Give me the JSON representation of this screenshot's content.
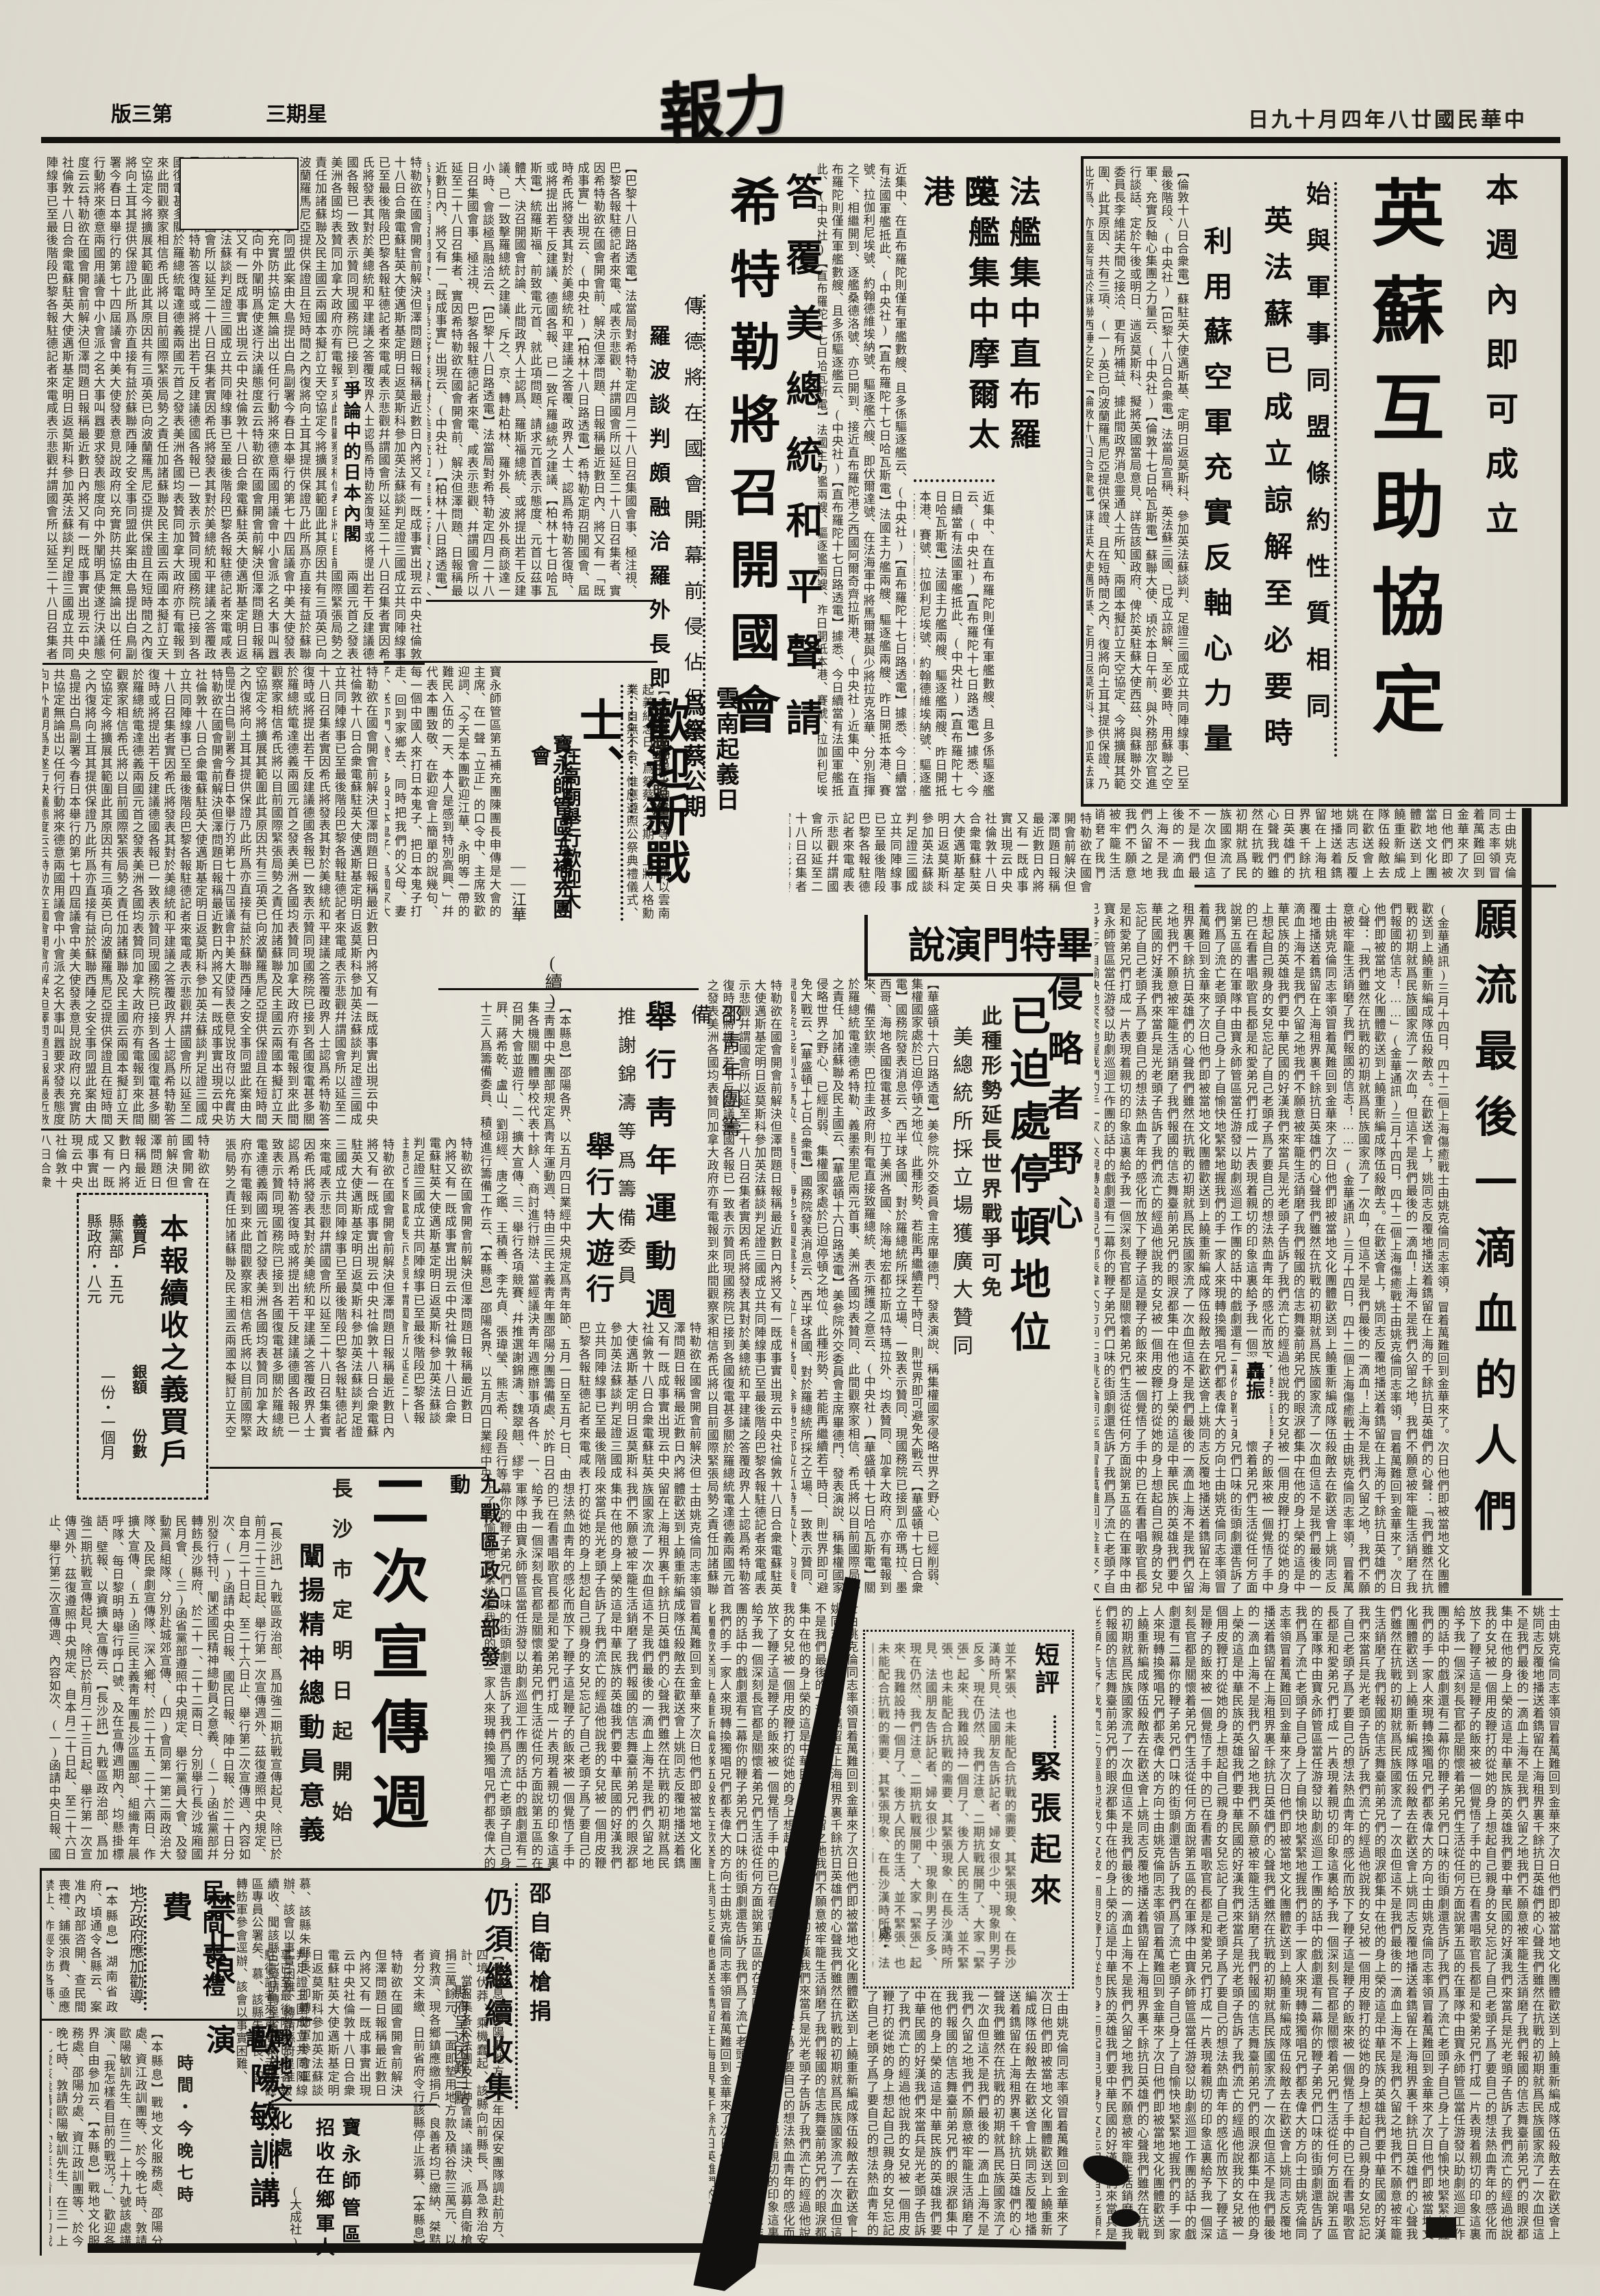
{
  "colors": {
    "ink": "#141310",
    "paper": "#e5e1d5"
  },
  "header": {
    "edition": "第三版",
    "weekday": "星期三",
    "masthead": "力報",
    "date": "中華民國廿八年四月十九日"
  },
  "a_yingsu": {
    "kicker": "本週內即可成立",
    "headline": "英蘇互助協定",
    "deck1": "始與軍事同盟條約性質相同",
    "deck2": "英法蘇已成立諒解至必要時",
    "deck3": "利用蘇空軍充實反軸心力量",
    "body": "【倫敦十八日合衆電】蘇駐英大使邁斯基、定明日返莫斯科、參加英法蘇談判、足證三國成立共同陣線事、已至最後階段、(中央社)【巴黎十八日合衆電】法當局宣稱、英法蘇三國、已成立諒解、至必要時、用蘇聯之空軍、充實反軸心集團之力量云、(中央社)【倫敦十七日哈瓦斯電】蘇聯大使、頃於本日午前、與外務部次官進行談話、定於午後或明日、遄返莫斯科、擬將英國當局意見、詳告該國政府、俾於英駐蘇大使西茲、與蘇聯外交委員長李維諾夫間之接洽、更有所補益、據此間政界消息靈通人士所知、兩國本擬訂立天空協定、今將擴展其範圍、此其原因、共有三項、(一)英已向波蘭羅馬尼亞提供保證、且在短時間之內、復將向土耳其提供保證、乃此所爲、亦直接有益於蘇聯西陲之安全"
  },
  "a_fajian": {
    "h1": "法艦集中直布羅陀",
    "h2": "英艦集中摩爾太港",
    "body": "近集中、在直布羅陀則僅有軍艦數艘、且多係驅逐艦云、(中央社)【直布羅陀十七日路透電】據悉、今日續當有法國軍艦抵此、(中央社)【直布羅陀十七日哈瓦斯電】法國主力艦兩艘、驅逐艦兩艘、昨日開抵本港、賽號、拉伽利尼埃號、約翰德維埃納號、驅逐艦六艘、即伏爾達號、在法海軍中將馬爾基與少將拉克洛華、分別指揮之下、相繼開到、逐艦桑德洛號、亦已開到、接近直布羅陀港之西國阿爾奇齊拉斯港、(中央社)"
  },
  "a_hitler": {
    "kicker": "答覆美總統和平聲請",
    "headline": "希特勒將召開國會",
    "deck": "傳德將在國會開幕前侵佔但澤",
    "sub": "羅波談判頗融洽羅外長即赴德",
    "body": "【巴黎十八日路透電】法當局對希特勒定四月二十八日召集國會事、極注視、巴黎各報駐德記者來電、咸表示悲觀、幷謂國會所以延至二十八日召集者、實因希特勒欲在國會開會前、解決但澤問題、日報稱最近數日內、將又有一「既成事實」出現云、(中央社)【柏林十八日路透電】希特勒定期召開國會、屆時希氏將發表其對於美總統和平建議之答覆、政界人士、認爲希特勒答復時、或將提出若干反建議、德國各報、已一致斥羅總統之建議、【柏林十七日哈瓦斯電】統羅斯福、前致電元首、就此項問題、請求元首表示態度、元首以茲事體大、決召開國會討論、此間政界人士認爲、羅斯福總統、或將提出若干反建議、已一致擊羅總統之建議、斥之、京、轉赴柏林、羅外長、波外長商談達一小時、會談極爲融洽云、"
  },
  "a_yunnan": {
    "h1": "雲南起義日",
    "h2": "爲祭蔡公期",
    "sub": "內政部已照准",
    "body": "【本縣息】邵陽士紳岳森等、前請以雲南起義紀念日、爲祭蔡公之期、上將人格勳業、自無不合、惟應遵照公祭典禮儀式、以昭隆重云、(大成社)"
  },
  "a_huanying": {
    "headline": "歡迎新戰士、",
    "cont": "(續)",
    "deck1": "寶永師管區五補充團",
    "deck2": "在高廟舉行歡迎大會",
    "byline": "——江華",
    "body": "寶永師管區第五補充團陳團長申傳是大會的主席、在一聲「立正」的口令中、主席致歡迎詞、「今天是本團歡迎江華、永明等一帶的難民入伍的一天、本人是感到特別高興、」幷代表本團致敬、在歡迎會上簡單的說幾句、每一個中國人來打日本鬼子、把日本鬼子打走、回到家鄉去、同時把我們的父母、妻子、送你們入營、多殺日本鬼子、爲國家大志願、但我們要抱定堅決、"
  },
  "a_qingnian": {
    "kicker": "邵靑年團籌備",
    "headline": "舉行靑年運動週",
    "sub1": "推謝錦濤等爲籌備委員",
    "head2": "舉行大遊行",
    "body": "【本縣息】邵陽各界、以五月四日業經中央規定爲靑年節、五月一日至五月七日、由三靑團中央團部規定爲靑年運動週、特由三民主義靑年團邵陽分團籌備處、於昨日召集各機關團體學校代表十餘人、商討進行辦法、當經議決靑年週應辦事項各件、一、召開大會並遊行、二、擴大宣傳、三、舉行各項競賽、幷推選謝錦濤、魏翠翹、繆宇屛、蔣希乾、盧山、劉翊經、唐之鑑、王積善、李先貞、張瑋瑩、熊志希、段吾行等十三人爲籌備委員、積極進行籌備工作云、"
  },
  "a_yibai": {
    "title": "本報續收之義買戶",
    "hdr1": "義買戶",
    "hdr2": "銀額",
    "hdr3": "份數",
    "row1": "縣黨部・五元",
    "row2": "縣政府・八元",
    "row3": "一份・一個月"
  },
  "a_bitemen": {
    "headline": "畢特門演說",
    "deck1": "侵略者野心",
    "deck2": "已迫處停頓地位",
    "sub1": "此種形勢延長世界戰爭可免",
    "sub2": "美總統所採立場獲廣大贊同",
    "body": "【華盛頓十六日路透電】美參院外交委員會主席畢德門、發表演說、稱集權國家侵略世界之野心、已經削弱、集權國家處於已迫停頓之地位、此種形勢、若能再繼續若干時日、則世界即可避免大戰云、【華盛頓十七日合衆電】國務院發表消息云、西半球各國、對於羅總統所採之立場、一致表示贊同、現國務院已接到瓜帝瑪拉、墨西哥、海地各國復電甚多、拉丁美洲各國、除海地宏都拉斯瓜特瑪拉外、均表贊同、加拿大政府、亦有電報到來、備至欽崇、巴拉圭政府則有電直接致羅總統、表示擁護之意云、(中央社)【華盛頓十七日哈瓦斯電】關於羅總統電達德希特勒、義墨索里尼兩元首事、美洲各國均表贊同、此間觀察家相信、希氏將以目前國際局勢之責任、加諸蘇聯及民主國云、"
  },
  "a_yuanliu": {
    "headline": "願流最後一滴血的人們",
    "byline": "轟振",
    "lead": "(金華通訊)三月十四日，四十二個上海傷癒戰士由姚克倫同志率領，冒着萬難回到金華來了。次日他們即被當地文化團體歡送到上饒重新編成隊伍殺敵去。在歡送會上，姚同志反覆地播送着鐫留在上海的千餘抗日英雄們的心聲：「我們雖然在抗戰的初期就爲民族國家流了一次血，但這不是我們最後的一滴血！上海不是我們久留之地，我們不願意被牢籠生活銷磨了我們報國的信志！……」"
  },
  "a_duanping": {
    "label": "短評",
    "headline": "緊張起來",
    "sign": "處・",
    "body": "並不緊張、也未能配合抗戰的需要、其緊張現象、在長沙漢時所見、法國朋友告訴記者、婦女很少中、現象則男子反多、現在仍然、我們注意、二期抗戰展開了、大家「緊張」起來、我難設持一個月了、後方人民的生活、"
  },
  "a_xuanchuan": {
    "kicker": "九戰區政治部發動",
    "headline": "二次宣傳週",
    "sub1": "長沙市定明日起開始",
    "sub2": "闡揚精神總動員意義",
    "body": "【長沙訊】九戰區政治部、爲加強二期抗戰宣傳起見、除已於前月二十三日起、舉行第一次宣傳週外、茲復遵照中央規定、自本月二十日起、至二十六日止、舉行第二次宣傳週、內容如次、(一)函請中央日報、國民日報、陣中日報、於二十日分別發行特刊、闡述國民精神總動員之意義、(二)函省黨部幷轉飭長沙縣府、於二十一、二十二兩日、分別舉行長沙城廂國民月會、(三)函省黨部遵照中央規定、舉行黨員大會、及發動黨員組隊、分別赴城郊宣傳、(四)會同第一第二兩政治大隊、及民衆劇宣傳隊、深入鄉村、於二十五、二十六兩日、作擴大宣傳、(五)函三民主義靑年團長沙區團部、組織靑年晨呼隊、每日黎明時舉行呼口號、及在宣傳週期內、均懸掛標語、壁報、以資擴大宣傳云、"
  },
  "a_sangli": {
    "kicker": "地方政府應加勸導",
    "h1": "民間喪禮",
    "h2": "禁止浪費",
    "body": "【本縣息】湖南省政府、頃通令各縣云、案准內政部咨開、查民間喪禮、鋪張浪費、亟應禁止、昨經令飭各縣、查照辦理以資勸導云、"
  },
  "a_ouyang": {
    "kicker": "戰地文化處請",
    "headline": "歐陽敏訓講演",
    "sub": "時間・今晚七時",
    "body": "【本縣息】戰地文化服務處、邵陽分處、資江政訓團等、於今晚七時、敦請歐陽敏訓先生、在三一上十九號該處講演、「我怎樣看目前的戰況？」、歡迎各界自由參加云、"
  },
  "a_shaozi": {
    "kicker": "邵自衛槍捐",
    "headline": "仍須繼續收集",
    "sub": "縣府呈述困難三點",
    "body": "【本縣息】邵陽縣地方、上年因保安團隊調赴前方、四境伏莽、乘機蠢起、該縣向前縣長、爲急救治安計、當召集各公法團及士紳會議、議決、派募自衛槍捐三萬餘元、一面即墊用地方款及積谷款三萬元、以資救濟、現各鄉鎮應繳捐戶、良善者均已繳納、桀黠者分文未繳、日前省府令行該縣停止派募、",
    "tail": "慕、該縣朱縣長、即轉飭軍參會逕辦、該會以事實困難、轉請縣府呈准續收、聞該縣已擬請轉呈省政府及六區專員公署矣、"
  },
  "a_baoyong": {
    "h1": "寶永師管區",
    "h2": "招收在鄉軍人",
    "agency": "(大成社)"
  },
  "a_japan": {
    "sub": "爭論中的日本內閣"
  },
  "texture": "特勒欲在國會開會前解決但澤問題日報稱最近數日內將又有一既成事實出現云中央社倫敦十八日合衆電蘇駐英大使邁斯基定明日返莫斯科參加英法蘇談判足證三國成立共同陣線事已至最後階段巴黎各報駐德記者來電咸表示悲觀幷謂國會所以延至二十八日召集者實因希氏將發表其對於美總統和平建議之答覆政界人士認爲希特勒答復時或將提出若干反建議德國各報已一致表示贊同現國務院已接到各國復電甚多關於羅總統電達德義兩國元首之發表美洲各國均表贊同加拿大政府亦有電報到來此間觀察家相信希氏將以目前國際緊張局勢之責任加諸蘇聯及民主國云兩國本擬訂立天空協定今將擴展其範圍此其原因共有三項英已向波蘭羅馬尼亞提供保證且在短時間之內復將向土耳其提供保證乃此所爲亦直接有益於蘇聯西陲之安全事同盟此案由大島提出白鳥副署今春日本舉行的第七十四屆議會中美大使發表意見說政府以充實防共協定無論出以任何行動將來德意兩國用議會中小會派之名大事叫囂要求發表態度向中外闡明爲使遂行決議態度云云",
  "story": "士由姚克倫同志率領冒着萬難回到金華來了次日他們即被當地文化團體歡送到上饒重新編成隊伍殺敵去在歡送會上姚同志反覆地播送着鐫留在上海租界裏千餘抗日英雄們的心聲我們雖然在抗戰的初期就爲民族國家流了一次血但這不是我們最後的一滴血上海不是我們久留之地我們不願意被牢籠生活銷磨了我們報國的信志舞臺前弟兄們的眼淚都集中在他的身上榮的這是中華民族的英雄我們要中華民國的好漢我們來當兵是光老頭子告訴了我們流亡的經過他說我的女兒被一個用皮鞭打的從她的身上想起自己親身的女兒忘記了自己老頭子爲了要自己的想法熱血靑年的感化而放下了鞭子這是鞭子的飯來被一個覺悟了手中的已在看書唱歌官長都是和愛弟兄們打成一片表現着親切的印象這裏給予我一個深刻長官都是關懷着弟兄們生活從任何方面說第五區的在軍隊中由寶永師管區當任游發以助劇巡迴工作團的話中的戲劇還有二幕你的鞭子弟兄們口味的街頭劇還告訴了我們爲了流亡老頭子自己身上了自愉快地緊緊地握我們的手一家人來現轉換獨唱兄們都表偉大的方向"
}
